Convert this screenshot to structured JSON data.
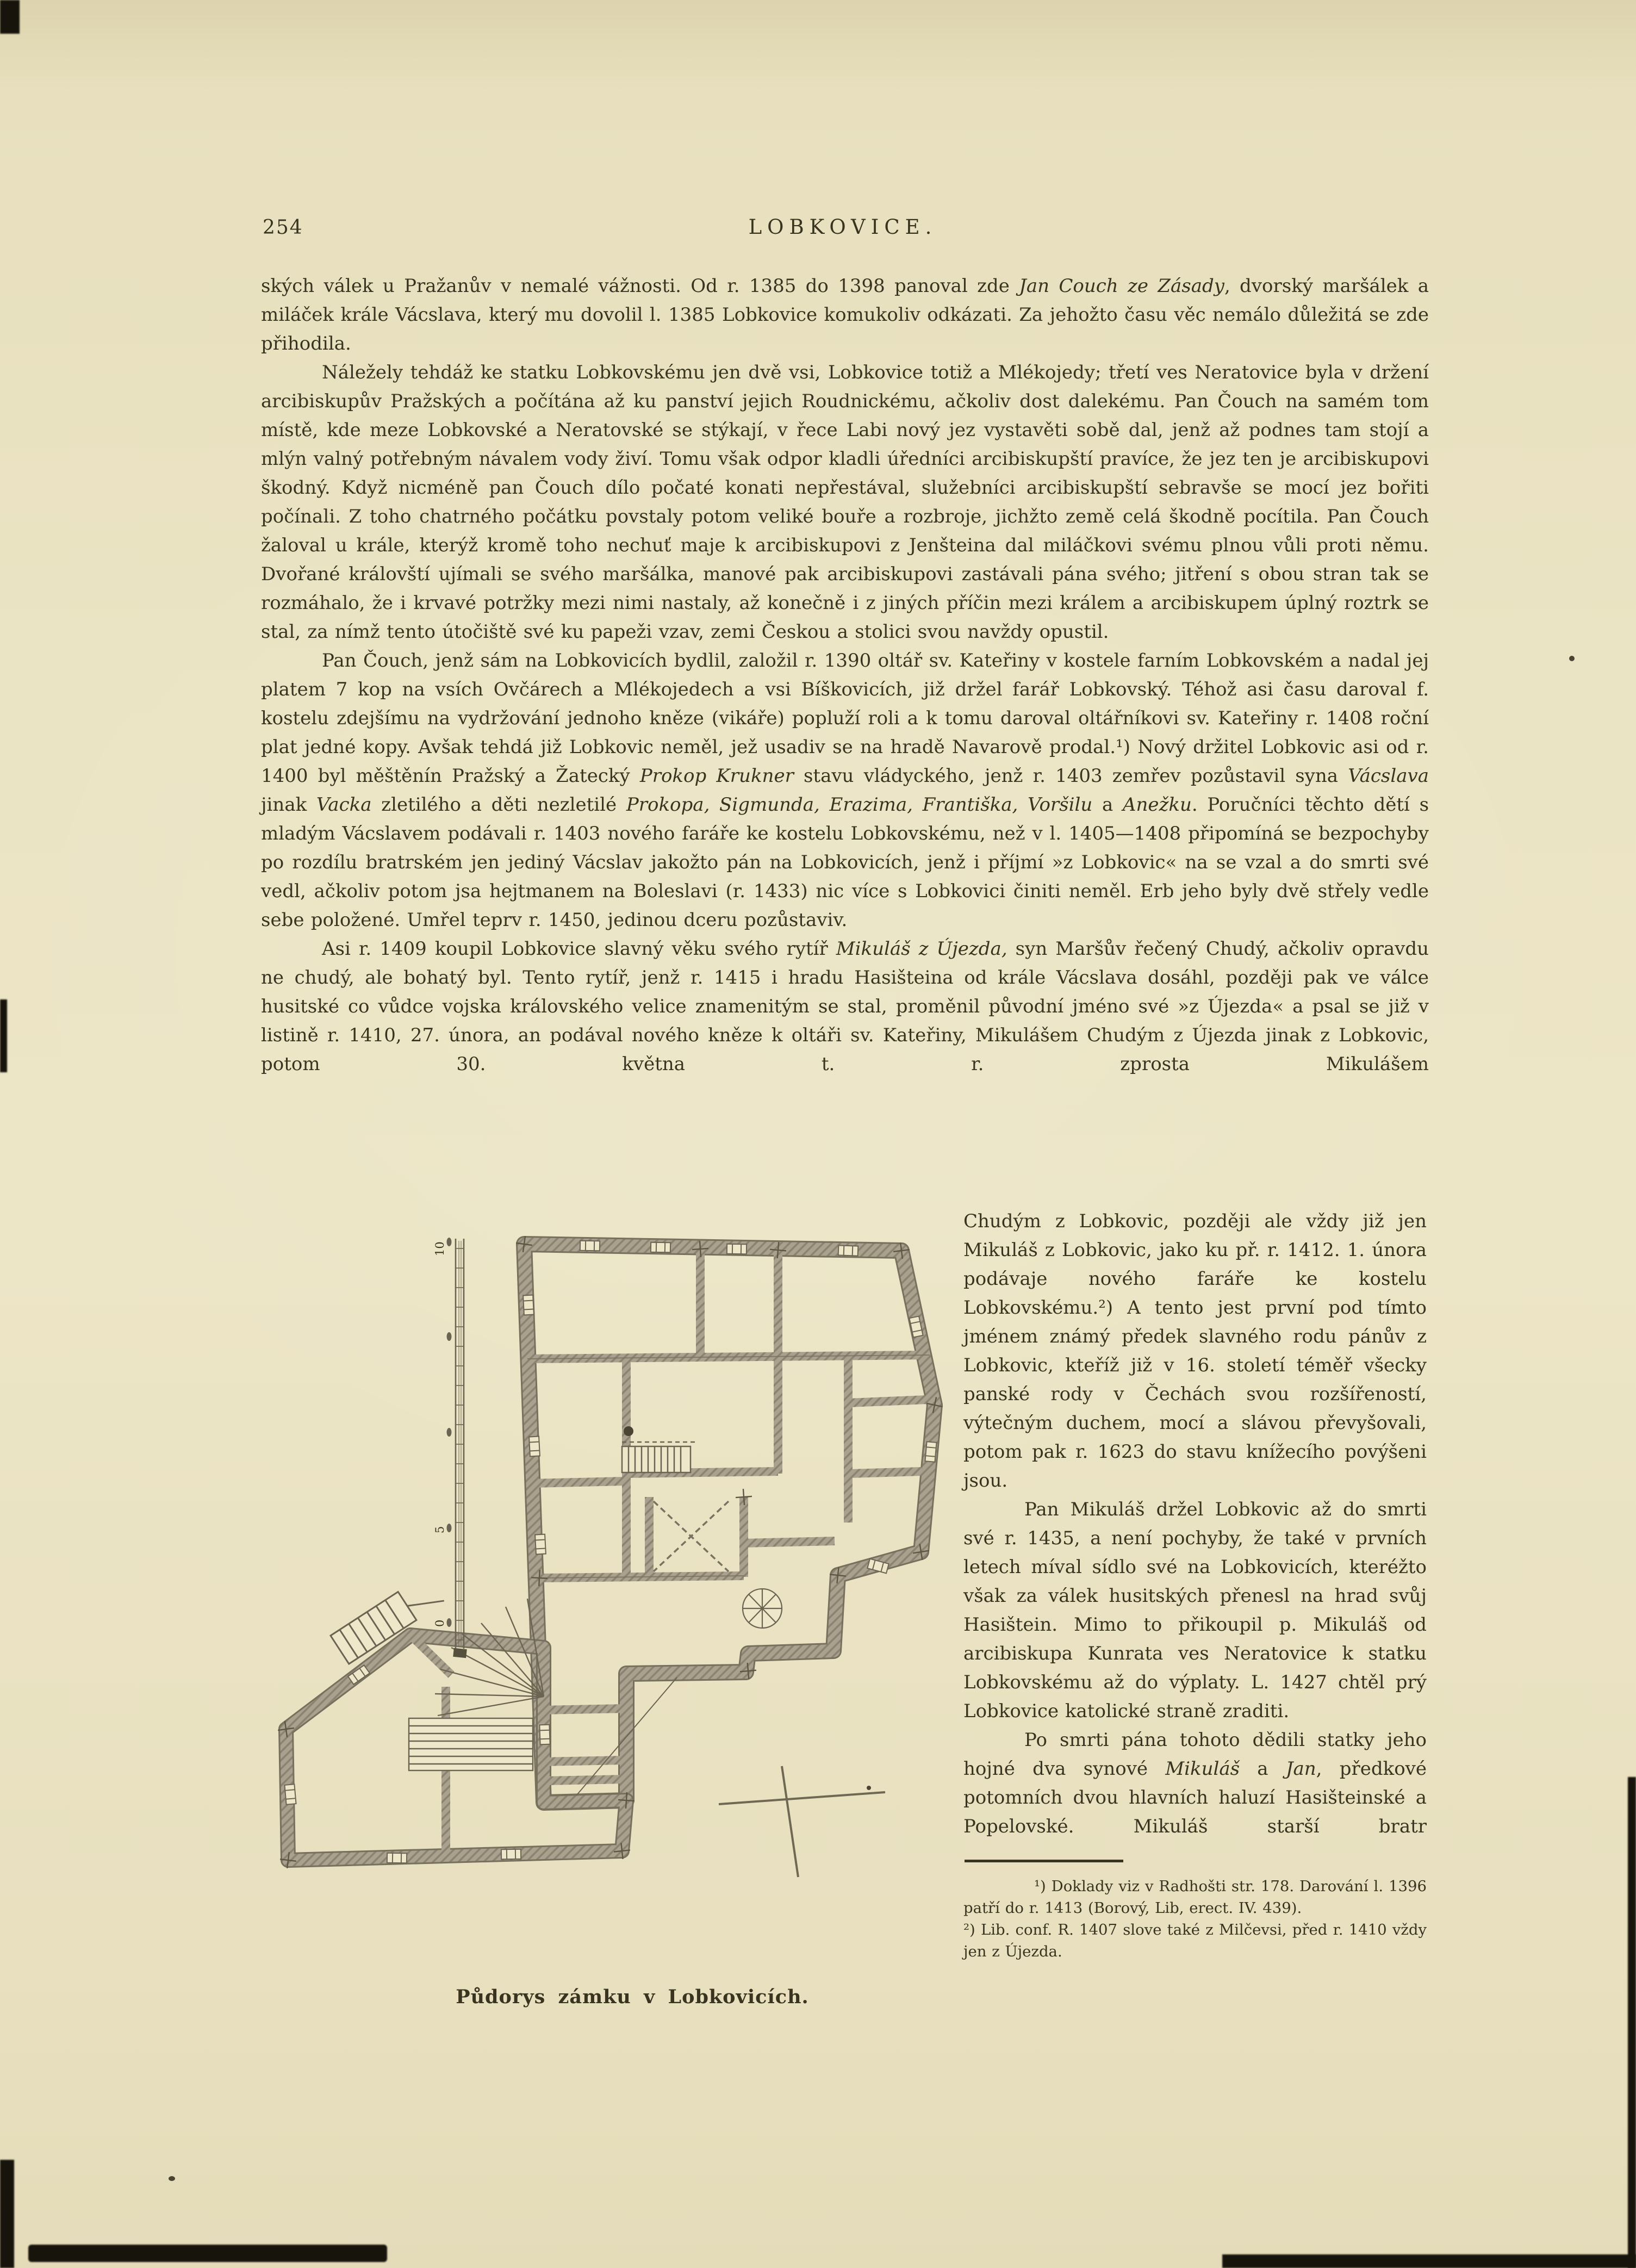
{
  "page": {
    "number": "254",
    "title": "LOBKOVICE."
  },
  "body": {
    "paragraphs": [
      {
        "indent": false,
        "jl": false,
        "runs": [
          {
            "t": "ských válek u Pražanův v nemalé vážnosti. Od r. 1385 do 1398 panoval zde "
          },
          {
            "t": "Jan Couch ze Zásady",
            "i": true
          },
          {
            "t": ", dvorský maršálek a miláček krále Vácslava, který mu dovolil l. 1385 Lobkovice komukoliv odkázati. Za jehožto času věc nemálo důležitá se zde přihodila."
          }
        ]
      },
      {
        "indent": true,
        "jl": false,
        "runs": [
          {
            "t": "Náležely tehdáž ke statku Lobkovskému jen dvě vsi, Lobkovice totiž a Mlékojedy; třetí ves Neratovice byla v držení arcibiskupův Pražských a počítána až ku panství jejich Roudnickému, ačkoliv dost dalekému. Pan Čouch na samém tom místě, kde meze Lobkovské a Neratovské se stýkají, v řece Labi nový jez vystavěti sobě dal, jenž až podnes tam stojí a mlýn valný potřebným návalem vody živí. Tomu však odpor kladli úředníci arcibiskupští pravíce, že jez ten je arcibiskupovi škodný. Když nicméně pan Čouch dílo počaté konati nepřestával, služebníci arcibiskupští sebravše se mocí jez bořiti počínali. Z toho chatrného počátku povstaly potom veliké bouře a rozbroje, jichžto země celá škodně pocítila. Pan Čouch žaloval u krále, kterýž kromě toho nechuť maje k arcibiskupovi z Jenšteina dal miláčkovi svému plnou vůli proti němu. Dvořané královští ujímali se svého maršálka, manové pak arcibiskupovi zastávali pána svého; jitření s obou stran tak se rozmáhalo, že i krvavé potržky mezi nimi nastaly, až konečně i z jiných příčin mezi králem a arcibiskupem úplný roztrk se stal, za nímž tento útočiště své ku papeži vzav, zemi Českou a stolici svou navždy opustil."
          }
        ]
      },
      {
        "indent": true,
        "jl": false,
        "runs": [
          {
            "t": "Pan Čouch, jenž sám na Lobkovicích bydlil, založil r. 1390 oltář sv. Kateřiny v kostele farním Lobkovském a nadal jej platem 7 kop na vsích Ovčárech a Mlékojedech a vsi Bíškovicích, již držel farář Lobkovský. Téhož asi času daroval f. kostelu zdejšímu na vydržování jednoho kněze (vikáře) popluží roli a k tomu daroval oltářníkovi sv. Kateřiny r. 1408 roční plat jedné kopy. Avšak tehdá již Lobkovic neměl, jež usadiv se na hradě Navarově prodal.¹) Nový držitel Lobkovic asi od r. 1400 byl měštěnín Pražský a Žatecký "
          },
          {
            "t": "Prokop Krukner",
            "i": true
          },
          {
            "t": " stavu vládyckého, jenž r. 1403 zemřev pozůstavil syna "
          },
          {
            "t": "Vácslava",
            "i": true
          },
          {
            "t": " jinak "
          },
          {
            "t": "Vacka",
            "i": true
          },
          {
            "t": " zletilého a děti nezletilé "
          },
          {
            "t": "Prokopa, Sigmunda, Erazima, Františka, Voršilu",
            "i": true
          },
          {
            "t": " a "
          },
          {
            "t": "Anežku",
            "i": true
          },
          {
            "t": ". Poručníci těchto dětí s mladým Vácslavem podávali r. 1403 nového faráře ke kostelu Lobkovskému, než v l. 1405—1408 připomíná se bezpochyby po rozdílu bratrském jen jediný Vácslav jakožto pán na Lobkovicích, jenž i příjmí »z Lobkovic« na se vzal a do smrti své vedl, ačkoliv potom jsa hejtmanem na Boleslavi (r. 1433) nic více s Lobkovici činiti neměl. Erb jeho byly dvě střely vedle sebe položené. Umřel teprv r. 1450, jedinou dceru pozůstaviv."
          }
        ]
      },
      {
        "indent": true,
        "jl": true,
        "runs": [
          {
            "t": "Asi r. 1409 koupil Lobkovice slavný věku svého rytíř "
          },
          {
            "t": "Mikuláš z Újezda,",
            "i": true
          },
          {
            "t": " syn Maršův řečený Chudý, ačkoliv opravdu ne chudý, ale bohatý byl. Tento rytíř, jenž r. 1415 i hradu Hasišteina od krále Vácslava dosáhl, později pak ve válce husitské co vůdce vojska královského velice znamenitým se stal, proměnil původní jméno své »z Újezda« a psal se již v listině r. 1410, 27. února, an podával nového kněze k oltáři sv. Kateřiny, Mikulášem Chudým z Újezda jinak z Lobkovic, potom 30. května t. r. zprosta Mikulášem"
          }
        ]
      }
    ],
    "column_paragraphs": [
      {
        "indent": false,
        "jl": false,
        "runs": [
          {
            "t": "Chudým z Lobkovic, později ale vždy již jen Mikuláš z Lobkovic, jako ku př. r. 1412. 1. února podávaje nového faráře ke kostelu Lobkovskému.²) A tento jest první pod tímto jménem známý předek slavného rodu pánův z Lobkovic, kteříž již v 16. století téměř všecky panské rody v Čechách svou rozšířeností, výtečným duchem, mocí a slávou převyšovali, potom pak r. 1623 do stavu knížecího povýšeni jsou."
          }
        ]
      },
      {
        "indent": true,
        "jl": false,
        "runs": [
          {
            "t": "Pan Mikuláš držel Lobkovic až do smrti své r. 1435, a není pochyby, že také v prvních letech míval sídlo své na Lobkovicích, kteréžto však za válek husitských přenesl na hrad svůj Hasištein. Mimo to přikoupil p. Mikuláš od arcibiskupa Kunrata ves Neratovice k statku Lobkovskému až do výplaty. L. 1427 chtěl prý Lobkovice katolické straně zraditi."
          }
        ]
      },
      {
        "indent": true,
        "jl": true,
        "runs": [
          {
            "t": "Po smrti pána tohoto dědili statky jeho hojné dva synové "
          },
          {
            "t": "Mikuláš",
            "i": true
          },
          {
            "t": " a "
          },
          {
            "t": "Jan",
            "i": true
          },
          {
            "t": ", předkové potomních dvou hlavních haluzí Hasišteinské a Popelovské. Mikuláš starší bratr"
          }
        ]
      }
    ],
    "footnotes": [
      {
        "indent": true,
        "t": "¹) Doklady viz v Radhošti str. 178. Darování l. 1396 patří do r. 1413 (Borový, Lib, erect. IV. 439)."
      },
      {
        "indent": false,
        "t": "²) Lib. conf. R. 1407 slove také z Milčevsi, před r. 1410 vždy jen z Újezda."
      }
    ]
  },
  "figure": {
    "caption": "Půdorys zámku v Lobkovicích.",
    "scale_labels": [
      "10",
      "5",
      "0"
    ]
  },
  "colors": {
    "paper": "#ebe4c4",
    "ink": "#39341f",
    "wall": "#a9a08d",
    "wall_edge": "#77705d"
  }
}
